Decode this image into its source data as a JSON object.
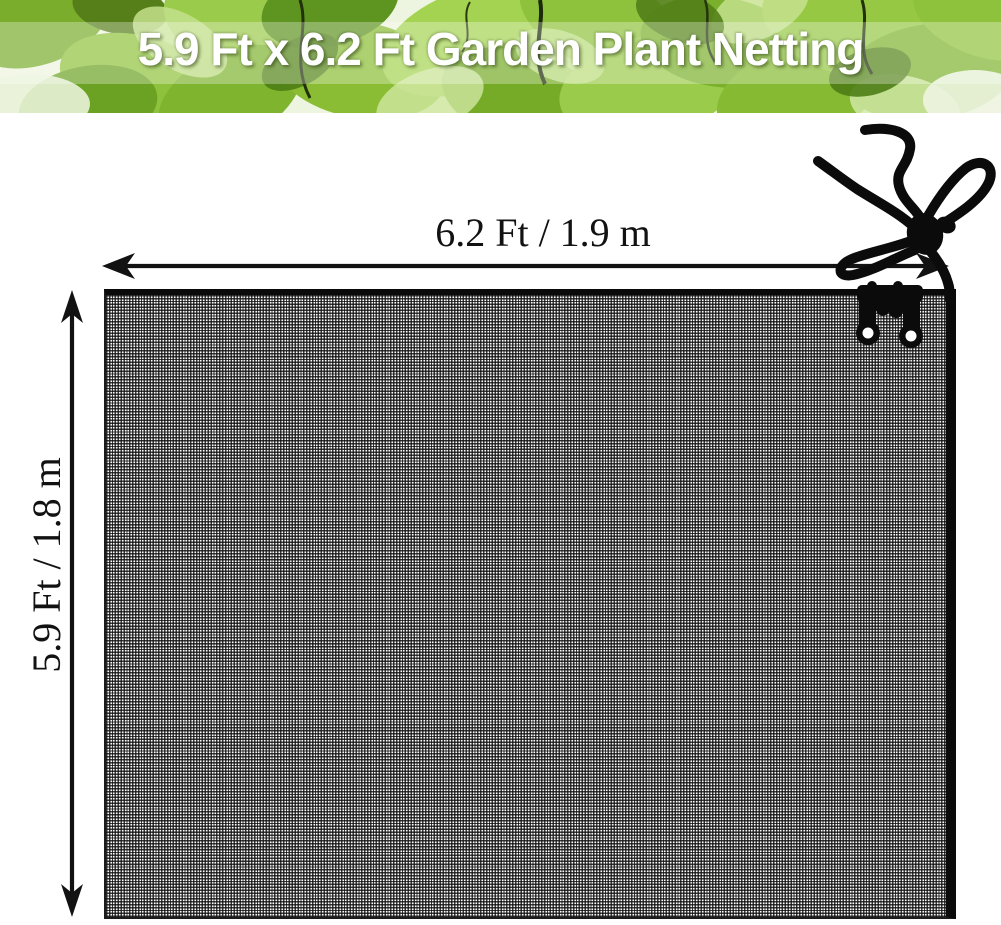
{
  "banner": {
    "title": "5.9 Ft x 6.2 Ft Garden Plant Netting",
    "text_color": "#ffffff",
    "leaf_green": "#8cc23c"
  },
  "net": {
    "color": "#111111",
    "mesh_hole_color": "#ffffff"
  },
  "dimensions": {
    "width_label": "6.2 Ft / 1.9 m",
    "height_label": "5.9 Ft / 1.8 m",
    "annotation_color": "#121212"
  },
  "icons": [
    {
      "name": "width-arrow-icon",
      "shape": "double-headed horizontal measurement arrow"
    },
    {
      "name": "height-arrow-icon",
      "shape": "double-headed vertical measurement arrow"
    },
    {
      "name": "cord-lock-toggle-icon",
      "shape": "drawstring cords with round toggle bead"
    },
    {
      "name": "net-clip-icon",
      "shape": "double-prong clip with two eyelet holes"
    }
  ]
}
